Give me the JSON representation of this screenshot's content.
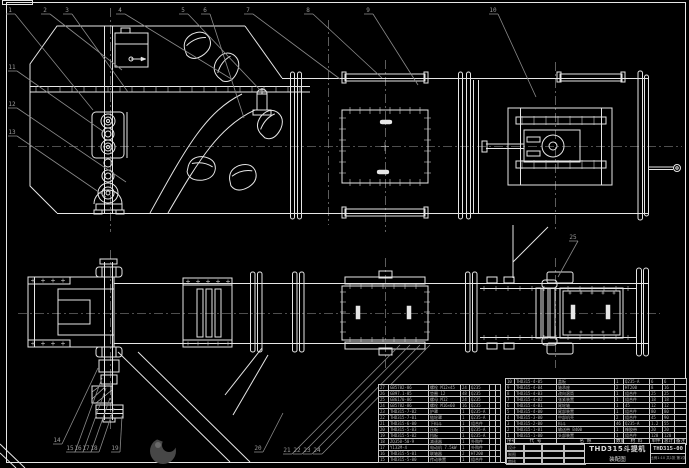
{
  "sheet": {
    "bg": "#000000",
    "line_color": "#e6e6e6",
    "leader_color": "#8a8a8a"
  },
  "title_block": {
    "product": "THD315斗提机",
    "doc_type": "装配图",
    "drawing_no": "THD315-00",
    "sheet_note": "比例1:10 共1张 第1张",
    "sign_rows": [
      "设计",
      "制图",
      "审核"
    ]
  },
  "bom_right": {
    "headers": [
      "序号",
      "代 号",
      "名 称",
      "数量",
      "材 料",
      "单件",
      "总计",
      "备注"
    ],
    "rows": [
      [
        "10",
        "THD315-4-05",
        "盖板",
        "1",
        "Q235-A",
        "6",
        "6",
        ""
      ],
      [
        "9",
        "THD315-4-04",
        "轴承座",
        "2",
        "HT200",
        "8",
        "16",
        ""
      ],
      [
        "8",
        "THD315-4-03",
        "改向滚筒",
        "1",
        "组合件",
        "25",
        "25",
        ""
      ],
      [
        "7",
        "THD315-4-02",
        "张紧装置",
        "1",
        "组合件",
        "18",
        "18",
        ""
      ],
      [
        "6",
        "THD315-4-01",
        "尾轮轴",
        "1",
        "45",
        "12",
        "12",
        ""
      ],
      [
        "5",
        "THD315-4-00",
        "尾部装置",
        "1",
        "组合件",
        "80",
        "80",
        ""
      ],
      [
        "4",
        "THD315-3-00",
        "中部机壳",
        "2",
        "组合件",
        "45",
        "90",
        ""
      ],
      [
        "3",
        "THD315-2-00",
        "料斗",
        "46",
        "Q235-A",
        "1.2",
        "55",
        ""
      ],
      [
        "2",
        "THD315-1-01",
        "输送带 B400",
        "1",
        "橡胶带",
        "20",
        "20",
        ""
      ],
      [
        "1",
        "THD315-1-00",
        "头部装置",
        "1",
        "组合件",
        "120",
        "120",
        ""
      ]
    ]
  },
  "bom_left": {
    "rows": [
      [
        "27",
        "GB5782-86",
        "螺栓 M12×45",
        "24",
        "Q235",
        "",
        ""
      ],
      [
        "26",
        "GB97.1-85",
        "垫圈 12",
        "48",
        "Q235",
        "",
        ""
      ],
      [
        "25",
        "GB6170-86",
        "螺母 M12",
        "24",
        "Q235",
        "",
        ""
      ],
      [
        "24",
        "GB5782-86",
        "螺栓 M16×60",
        "16",
        "Q235",
        "",
        ""
      ],
      [
        "23",
        "THD315-7-02",
        "护罩",
        "1",
        "Q235-A",
        "",
        ""
      ],
      [
        "22",
        "THD315-7-01",
        "链轮罩",
        "1",
        "Q235-A",
        "",
        ""
      ],
      [
        "21",
        "THD315-6-00",
        "下料斗",
        "1",
        "组合件",
        "",
        ""
      ],
      [
        "20",
        "THD315-5-03",
        "压板",
        "2",
        "Q235-A",
        "",
        ""
      ],
      [
        "19",
        "THD315-5-02",
        "挡板",
        "1",
        "Q235-A",
        "",
        ""
      ],
      [
        "18",
        "ZQ350-50-9",
        "减速器",
        "1",
        "外购件",
        "",
        ""
      ],
      [
        "17",
        "Y132M-4",
        "电动机 7.5kW",
        "1",
        "外购件",
        "",
        ""
      ],
      [
        "16",
        "THD315-5-01",
        "联轴器",
        "2",
        "HT200",
        "",
        ""
      ],
      [
        "15",
        "THD315-5-00",
        "传动装置",
        "1",
        "组合件",
        "",
        ""
      ]
    ]
  },
  "balloons": {
    "top": [
      "1",
      "2",
      "3",
      "4",
      "5",
      "6",
      "7",
      "8",
      "9",
      "10"
    ],
    "left": [
      "11",
      "12",
      "13"
    ],
    "bottom_left": [
      "14",
      "15",
      "16",
      "17",
      "18",
      "19"
    ],
    "bottom_mid": [
      "20"
    ],
    "bottom_cluster": [
      "21",
      "22",
      "23",
      "24"
    ],
    "plan_right": [
      "25"
    ]
  }
}
